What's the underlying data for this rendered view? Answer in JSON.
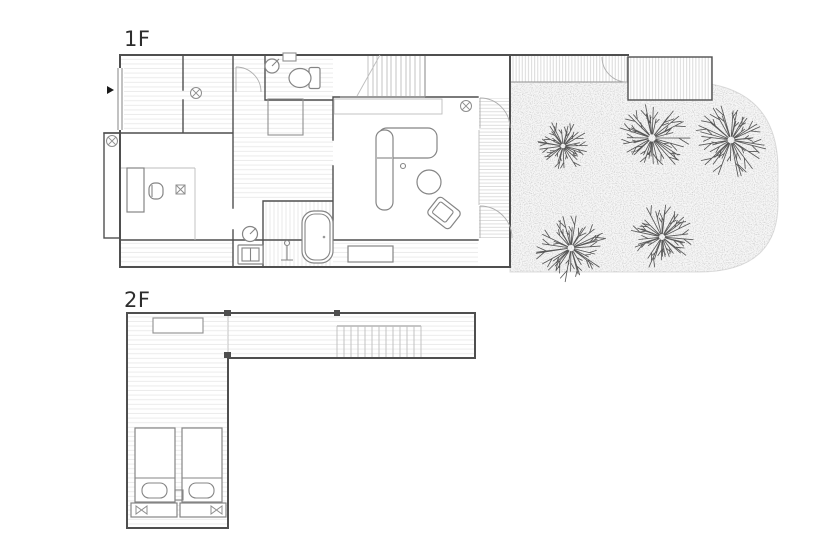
{
  "title": {
    "floor1_label": "1F",
    "floor2_label": "2F"
  },
  "colors": {
    "bg": "#ffffff",
    "wall": "#4f4f4f",
    "line_medium": "#8f8f8f",
    "line_light": "#bdbdbd",
    "furniture": "#858585",
    "floor_line": "#ebebeb",
    "stipple": "#9a9a9a",
    "tree": "#585858",
    "label": "#2d2d2d"
  },
  "garden": {
    "trees": [
      {
        "cx": 563,
        "cy": 146,
        "r": 27
      },
      {
        "cx": 652,
        "cy": 138,
        "r": 40
      },
      {
        "cx": 731,
        "cy": 140,
        "r": 38
      },
      {
        "cx": 571,
        "cy": 248,
        "r": 36
      },
      {
        "cx": 662,
        "cy": 237,
        "r": 33
      }
    ]
  }
}
